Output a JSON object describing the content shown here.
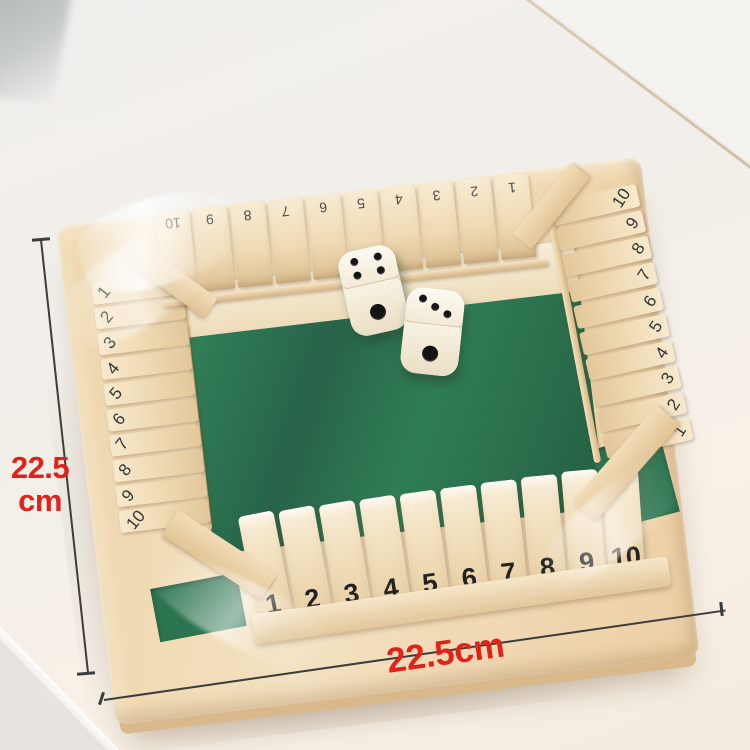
{
  "annotations": {
    "height_value": "22.5",
    "height_unit": "cm",
    "width_label": "22.5cm"
  },
  "board": {
    "top_row_numbers": [
      "10",
      "9",
      "8",
      "7",
      "6",
      "5",
      "4",
      "3",
      "2",
      "1"
    ],
    "left_row_numbers": [
      "1",
      "2",
      "3",
      "4",
      "5",
      "6",
      "7",
      "8",
      "9",
      "10"
    ],
    "right_row_numbers": [
      "10",
      "9",
      "8",
      "7",
      "6",
      "5",
      "4",
      "3",
      "2",
      "1"
    ],
    "bottom_row_numbers": [
      "1",
      "2",
      "3",
      "4",
      "5",
      "6",
      "7",
      "8",
      "9",
      "10"
    ],
    "dice": [
      {
        "top_face_pips": 4,
        "front_face_pips": 1
      },
      {
        "top_face_pips": 3,
        "front_face_pips": 1
      }
    ]
  },
  "colors": {
    "background": "#e7e4e0",
    "table_surface": "#f6f0e9",
    "table_edge": "#ffffff",
    "wood_light": "#f5e7cd",
    "wood_mid": "#eed6ad",
    "wood_dark": "#c9a87c",
    "felt_green": "#2e7a50",
    "tile_number": "#222222",
    "die_face": "#f6efe2",
    "pip": "#141414",
    "dimension_line": "#3c3c3c",
    "dimension_text": "#e32119"
  }
}
